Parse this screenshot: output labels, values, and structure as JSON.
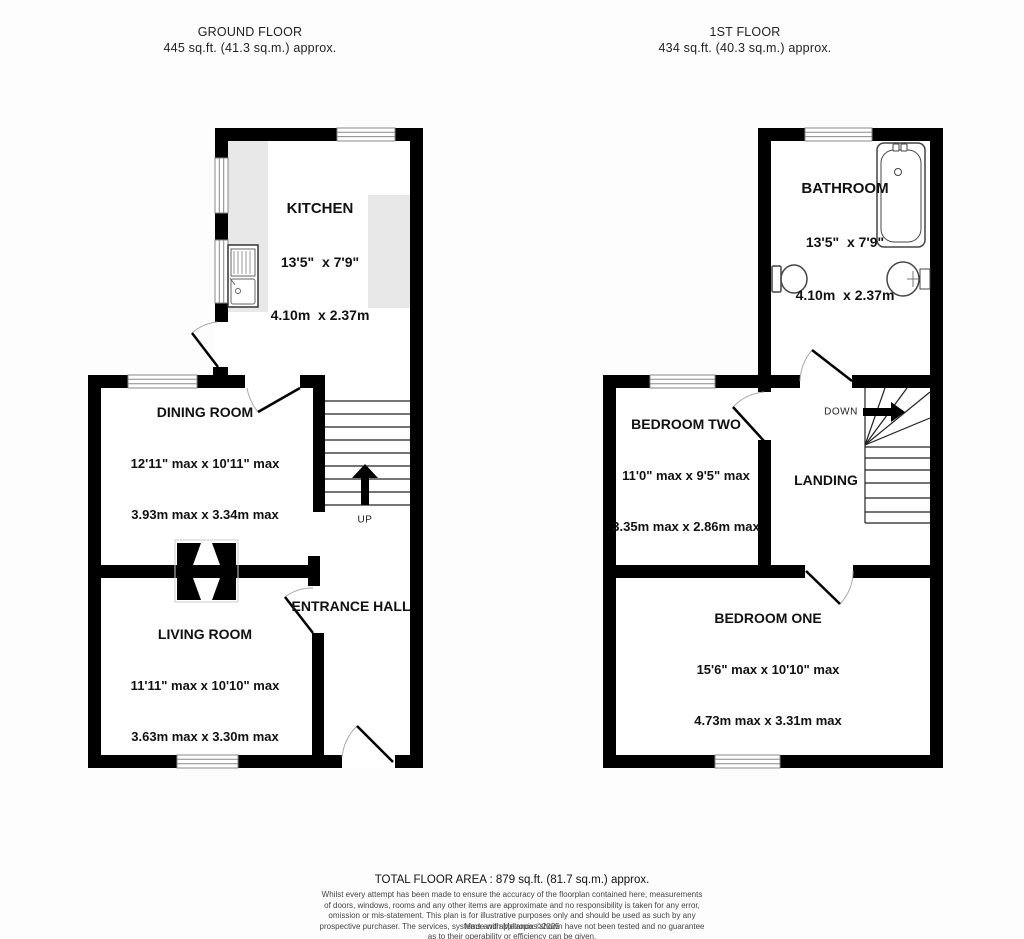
{
  "ground_floor": {
    "title": "GROUND FLOOR",
    "area": "445 sq.ft. (41.3 sq.m.) approx.",
    "stairs_label": "UP",
    "rooms": {
      "kitchen": {
        "name": "KITCHEN",
        "imperial": "13'5\"  x 7'9\"",
        "metric": "4.10m  x 2.37m"
      },
      "dining": {
        "name": "DINING ROOM",
        "imperial": "12'11\" max x 10'11\" max",
        "metric": "3.93m max x 3.34m max"
      },
      "living": {
        "name": "LIVING ROOM",
        "imperial": "11'11\" max x 10'10\" max",
        "metric": "3.63m max x 3.30m max"
      },
      "hall": {
        "name": "ENTRANCE HALL"
      }
    }
  },
  "first_floor": {
    "title": "1ST FLOOR",
    "area": "434 sq.ft. (40.3 sq.m.) approx.",
    "stairs_label": "DOWN",
    "rooms": {
      "bathroom": {
        "name": "BATHROOM",
        "imperial": "13'5\"  x 7'9\"",
        "metric": "4.10m  x 2.37m"
      },
      "bedroom_two": {
        "name": "BEDROOM TWO",
        "imperial": "11'0\" max x 9'5\" max",
        "metric": "3.35m max x 2.86m max"
      },
      "landing": {
        "name": "LANDING"
      },
      "bedroom_one": {
        "name": "BEDROOM ONE",
        "imperial": "15'6\" max x 10'10\" max",
        "metric": "4.73m max x 3.31m max"
      }
    }
  },
  "footer": {
    "total_area": "TOTAL FLOOR AREA : 879 sq.ft. (81.7 sq.m.) approx.",
    "disclaimer_lines": [
      "Whilst every attempt has been made to ensure the accuracy of the floorplan contained here, measurements",
      "of doors, windows, rooms and any other items are approximate and no responsibility is taken for any error,",
      "omission or mis-statement. This plan is for illustrative purposes only and should be used as such by any",
      "prospective purchaser. The services, systems and appliances shown have not been tested and no guarantee",
      "as to their operability or efficiency can be given.",
      "Made with Metropix ©2025"
    ]
  },
  "colors": {
    "wall": "#000000",
    "counter": "#e8e8e8",
    "door_arc": "#aaaaaa"
  }
}
